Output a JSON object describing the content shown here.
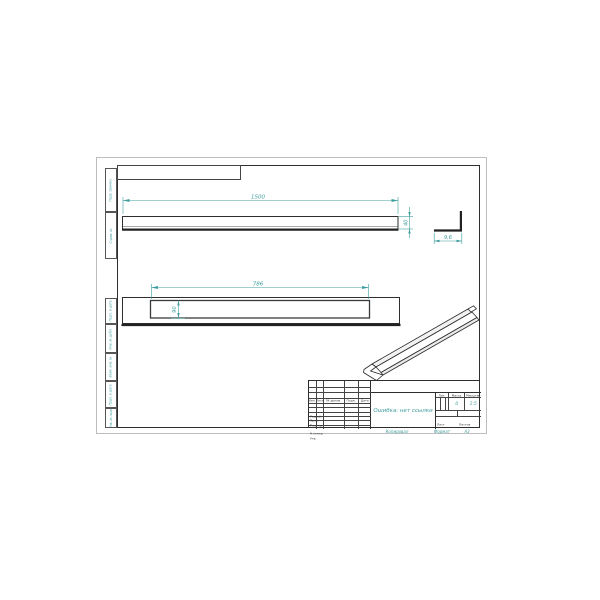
{
  "colors": {
    "dimension": "#3e9d9d",
    "drawing_line": "#2e2e2e",
    "paper_edge": "#bdbdbd"
  },
  "stamp_left": {
    "boxes": [
      {
        "label": "Перв. примен."
      },
      {
        "label": "Справ. №"
      },
      {
        "label": "Подп. и дата"
      },
      {
        "label": "Инв. № дубл."
      },
      {
        "label": "Взам. инв. №"
      },
      {
        "label": "Подп. и дата"
      },
      {
        "label": "Инв. № подл."
      }
    ]
  },
  "dimensions": {
    "top_length": "1500",
    "top_height": "40",
    "section_width": "9,6",
    "front_length": "786",
    "front_height": "90"
  },
  "title_block": {
    "change_header": [
      "Изм.",
      "Лист",
      "№ докум.",
      "Подп.",
      "Дата"
    ],
    "staff_rows": [
      "Разраб.",
      "Пров.",
      "Т.контр.",
      "",
      "Н.контр.",
      "Утв."
    ],
    "doc_name": "Ошибка: нет ссылки",
    "lit_label": "Лит.",
    "mass_label": "Масса",
    "scale_label": "Масштаб",
    "mass_value": "0",
    "scale_value": "1:5",
    "sheet_label": "Лист",
    "sheets_label": "Листов",
    "copy_label": "Копировал",
    "format_label": "Формат",
    "format_value": "А3"
  }
}
